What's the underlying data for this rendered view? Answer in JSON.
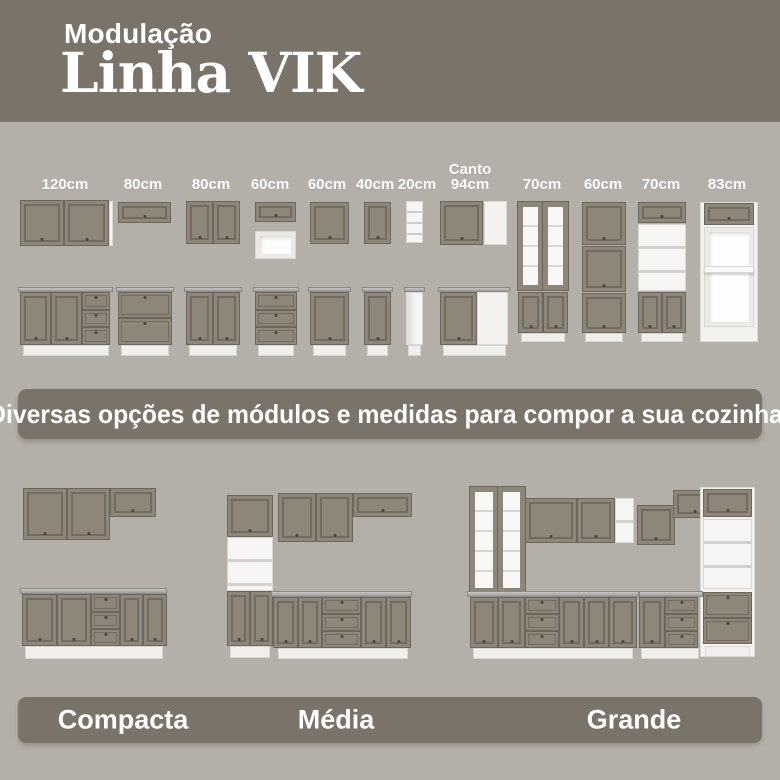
{
  "header": {
    "subtitle": "Modulação",
    "title": "Linha VIK"
  },
  "modules": {
    "labels": [
      "120cm",
      "80cm",
      "80cm",
      "60cm",
      "60cm",
      "40cm",
      "20cm",
      "Canto 94cm",
      "70cm",
      "60cm",
      "70cm",
      "83cm"
    ]
  },
  "banner": {
    "text": "Diversas opções de módulos e medidas para compor a sua cozinha!"
  },
  "kitchen_sizes": {
    "labels": [
      "Compacta",
      "Média",
      "Grande"
    ]
  },
  "colors": {
    "header_bg": "#7a7369",
    "page_bg": "#b4afa8",
    "cabinet_gray": "#8e8779",
    "carcass_white": "#f3f2ef"
  }
}
